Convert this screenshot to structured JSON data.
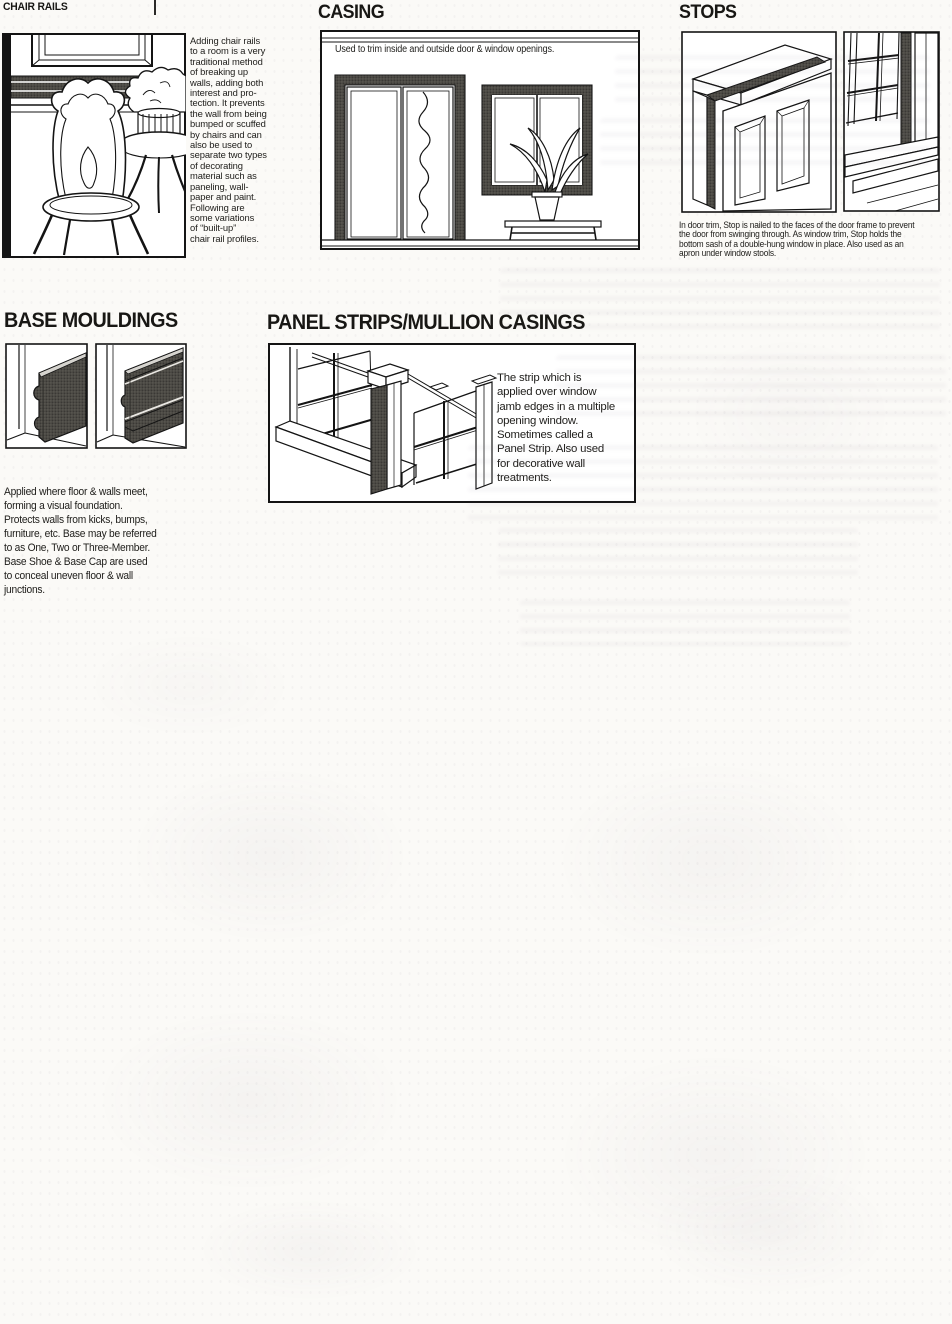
{
  "colors": {
    "ink": "#141414",
    "paper": "#fbfaf7",
    "moulding_fill": "#474540"
  },
  "sections": {
    "chair_rails": {
      "title": "CHAIR RAILS",
      "body": "Adding chair rails\nto a room is a very\ntraditional method\nof breaking up\nwalls, adding both\ninterest and pro-\ntection. It prevents\nthe wall from being\nbumped or scuffed\nby chairs and can\nalso be used to\nseparate two types\nof decorating\nmaterial such as\npaneling, wall-\npaper and paint.\nFollowing are\nsome variations\nof “built-up”\nchair rail profiles."
    },
    "casing": {
      "title": "CASING",
      "caption": "Used to trim inside and outside door & window openings."
    },
    "stops": {
      "title": "STOPS",
      "caption": "In door trim, Stop is nailed to the faces of the door frame to prevent\nthe door from swinging through. As window trim, Stop holds the\nbottom sash of a double-hung window in place. Also used as an\napron under window stools."
    },
    "base_mouldings": {
      "title": "BASE MOULDINGS",
      "caption": "Applied where floor & walls meet,\nforming a visual foundation.\nProtects walls from kicks, bumps,\nfurniture, etc. Base may be referred\nto as One, Two or Three-Member.\nBase Shoe & Base Cap are used\nto conceal uneven floor & wall\njunctions."
    },
    "panel_strips": {
      "title": "PANEL STRIPS/MULLION CASINGS",
      "caption": "The strip which is\napplied over window\njamb edges in a multiple\nopening window.\nSometimes called a\nPanel Strip. Also used\nfor decorative wall\ntreatments."
    }
  }
}
